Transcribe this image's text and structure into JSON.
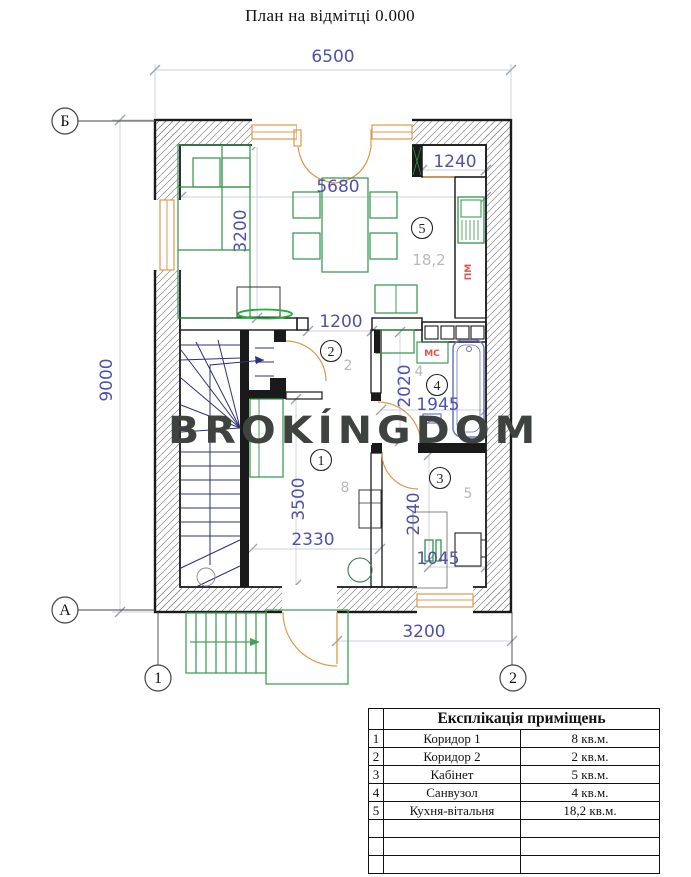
{
  "title": "План на відмітці 0.000",
  "watermark": "BROKÍNGDOM",
  "colors": {
    "wall": "#1a1a1a",
    "hatch": "#8a8a8a",
    "window_frame": "#dc9a4e",
    "furniture": "#2f9447",
    "tv": "#1fae37",
    "stairs": "#30307c",
    "plumbing": "#6a77c4",
    "porch": "#43a259",
    "dim_text": "#4f51ab",
    "dim_line": "#c8d0da",
    "area_label": "#b9b9bd",
    "appliance_label": "#e25050",
    "watermark": "#3e4340"
  },
  "axes": {
    "b": "Б",
    "a": "А",
    "c1": "1",
    "c2": "2"
  },
  "dims": {
    "overall_width": "6500",
    "overall_height": "9000",
    "kitchen_width": "5680",
    "kitchen_depth": "3200",
    "pantry_width": "1240",
    "kitchen_door": "1200",
    "bath_height": "2020",
    "bath_width": "1945",
    "hall_height": "3500",
    "hall_width": "2330",
    "office_height": "2040",
    "office_window": "1045",
    "entry_offset": "3200"
  },
  "rooms": {
    "r1": {
      "num": "1",
      "area": "8"
    },
    "r2": {
      "num": "2",
      "area": "2"
    },
    "r3": {
      "num": "3",
      "area": "5"
    },
    "r4": {
      "num": "4",
      "area": "4"
    },
    "r5": {
      "num": "5",
      "area": "18,2"
    }
  },
  "labels": {
    "washer": "МС",
    "dishwasher": "ПМ"
  },
  "legend": {
    "title": "Експлікація приміщень",
    "rows": [
      {
        "num": "1",
        "name": "Коридор 1",
        "area": "8 кв.м."
      },
      {
        "num": "2",
        "name": "Коридор 2",
        "area": "2 кв.м."
      },
      {
        "num": "3",
        "name": "Кабінет",
        "area": "5 кв.м."
      },
      {
        "num": "4",
        "name": "Санвузол",
        "area": "4 кв.м."
      },
      {
        "num": "5",
        "name": "Кухня-вітальня",
        "area": "18,2 кв.м."
      },
      {
        "num": "",
        "name": "",
        "area": ""
      },
      {
        "num": "",
        "name": "",
        "area": ""
      },
      {
        "num": "",
        "name": "",
        "area": ""
      }
    ]
  }
}
